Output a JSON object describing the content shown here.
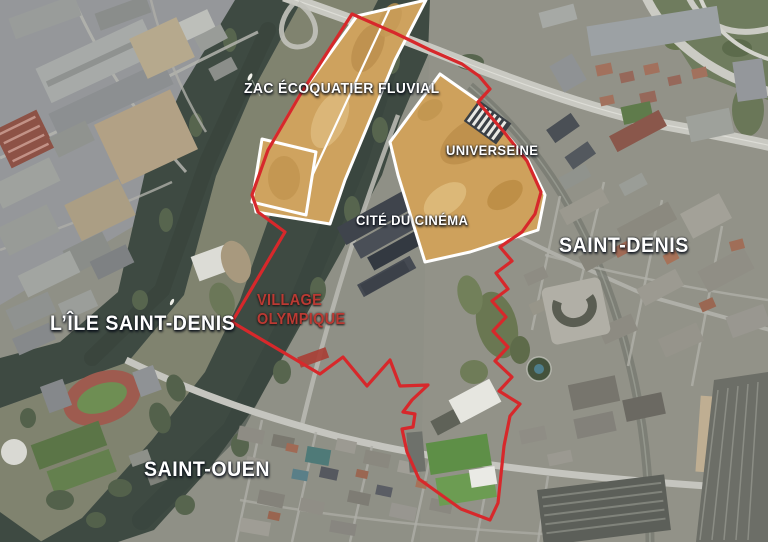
{
  "map": {
    "labels": {
      "zac": {
        "text": "ZAC ÉCOQUATIER FLUVIAL"
      },
      "universeine": {
        "text": "UNIVERSEINE"
      },
      "cite_du_cinema": {
        "text": "CITÉ DU CINÉMA"
      },
      "saint_denis": {
        "text": "SAINT-DENIS"
      },
      "ile_saint_denis": {
        "text": "L’ÎLE SAINT-DENIS"
      },
      "village_olympique": {
        "line1": "VILLAGE",
        "line2": "OLYMPIQUE"
      },
      "saint_ouen": {
        "text": "SAINT-OUEN"
      }
    },
    "overlay_colors": {
      "site_boundary": "#D7282B",
      "zone_outline": "#FFFFFF",
      "zone_highlight_fill": "#CEA15C",
      "red_label": "#BB3A33",
      "white_label": "#FFFFFF"
    }
  }
}
